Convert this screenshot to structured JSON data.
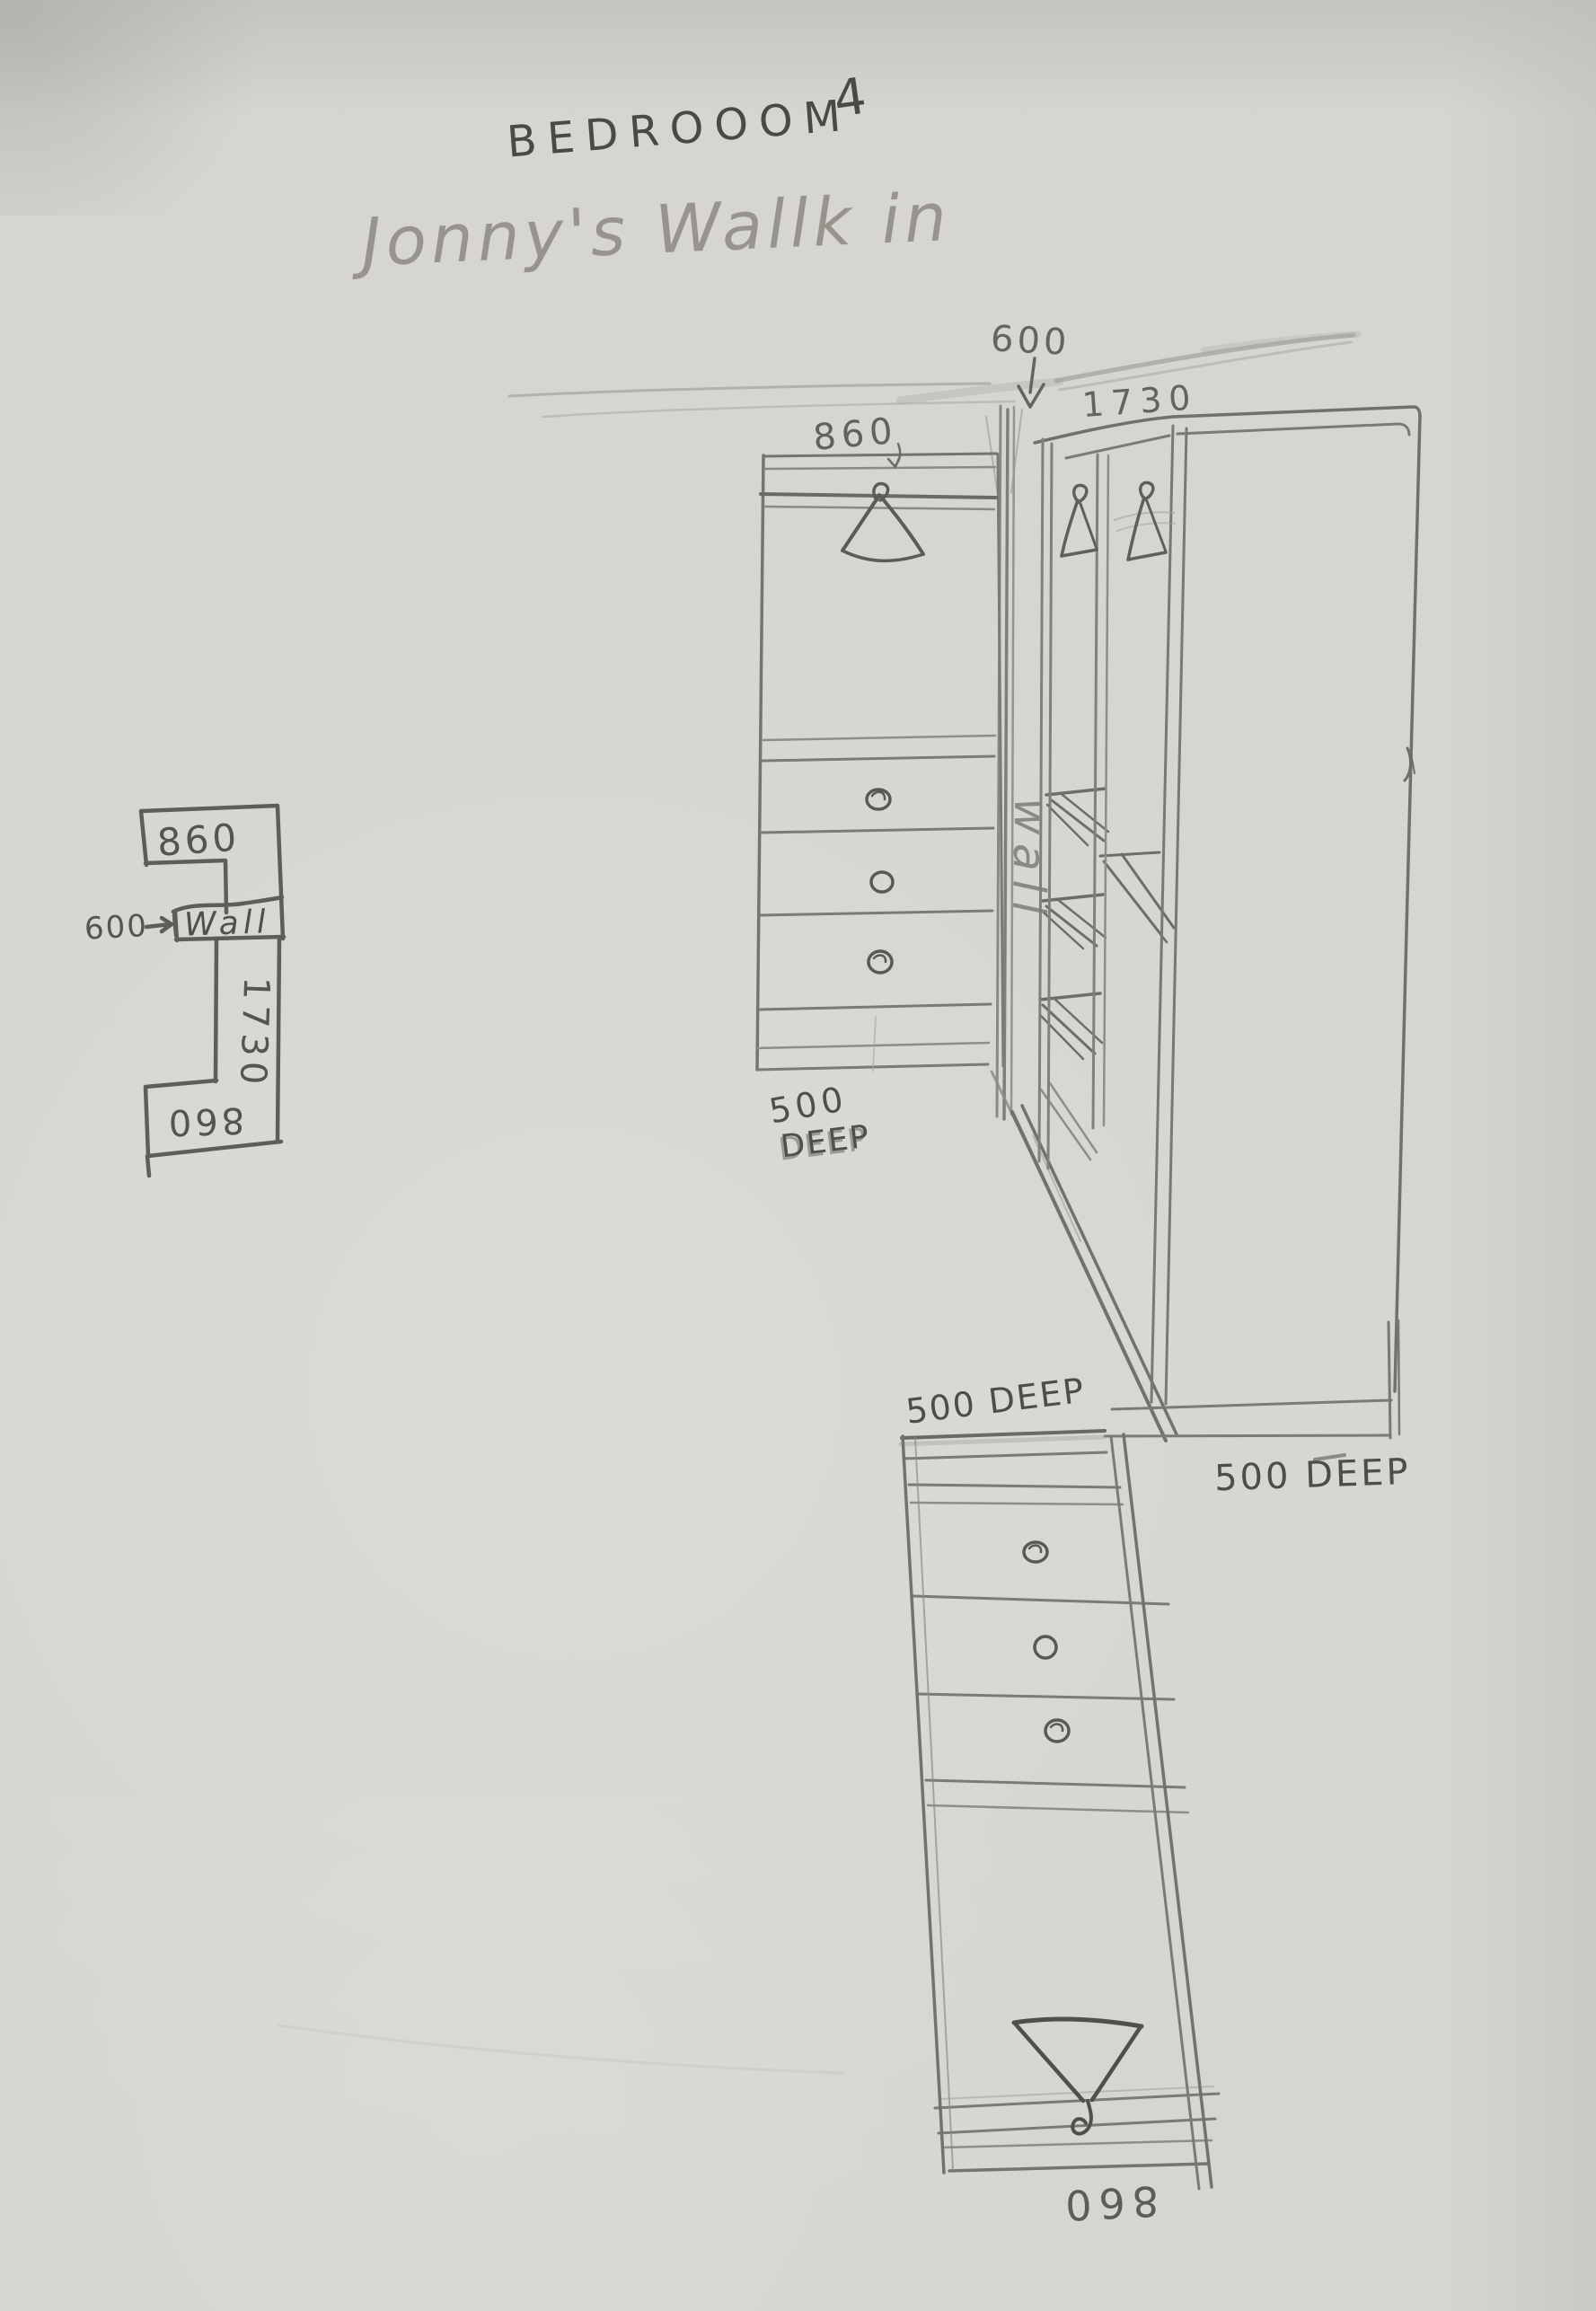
{
  "document": {
    "kind": "hand-drawn pencil sketch on paper",
    "paper_color": "#d6d5d1",
    "pencil_color": "#6b6963",
    "dark_pencil_color": "#4b4943"
  },
  "header": {
    "room_title": "BEDROOOM",
    "room_number": "4",
    "subtitle": "Jonny's Wallk in"
  },
  "plan_view": {
    "top_cabinet_width": "860",
    "doorway_width": "600",
    "wall_text": "Wall",
    "side_run_length": "1730",
    "bottom_cabinet_width": "860",
    "bottom_label_orientation": "upside-down"
  },
  "elevation_view": {
    "doorway_width": "600",
    "left_unit": {
      "width": "860",
      "depth_line1": "500",
      "depth_line2": "DEEP",
      "drawers": 3,
      "icon": "clothes-hanger-icon"
    },
    "wall_text": "wall",
    "right_unit": {
      "width": "1730",
      "depth": "500 DEEP",
      "hanger_icons": 2
    },
    "bottom_unit": {
      "depth": "500 DEEP",
      "width": "860",
      "width_label_orientation": "upside-down",
      "drawers": 3,
      "icon": "clothes-hanger-icon"
    }
  }
}
